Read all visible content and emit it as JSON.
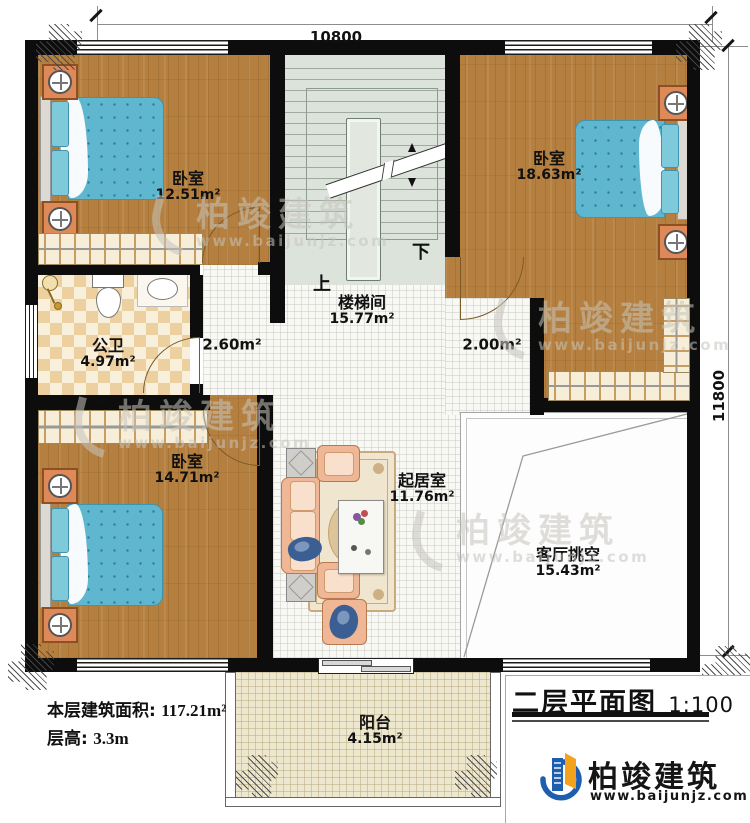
{
  "drawing": {
    "title": "二层平面图",
    "scale": "1:100",
    "dim_top": "10800",
    "dim_right": "11800"
  },
  "rooms": {
    "bedroom_tl": {
      "name": "卧室",
      "area": "12.51m²"
    },
    "bedroom_tr": {
      "name": "卧室",
      "area": "18.63m²"
    },
    "bedroom_bl": {
      "name": "卧室",
      "area": "14.71m²"
    },
    "bathroom": {
      "name": "公卫",
      "area": "4.97m²"
    },
    "stairwell": {
      "name": "楼梯间",
      "area": "15.77m²"
    },
    "hall_left": {
      "area": "2.60m²"
    },
    "hall_right": {
      "area": "2.00m²"
    },
    "living": {
      "name": "起居室",
      "area": "11.76m²"
    },
    "void": {
      "name": "客厅挑空",
      "area": "15.43m²"
    },
    "balcony": {
      "name": "阳台",
      "area": "4.15m²"
    }
  },
  "stairs": {
    "up": "上",
    "down": "下"
  },
  "info": {
    "area_label": "本层建筑面积:",
    "area_value": "117.21m²",
    "height_label": "层高:",
    "height_value": "3.3m"
  },
  "brand": {
    "name": "柏竣建筑",
    "website": "www.baijunjz.com"
  },
  "colors": {
    "wall": "#0d0d0d",
    "wood_floor": "#b5803f",
    "stair_floor": "#dce3da",
    "bed_blue": "#5fb6cf",
    "logo_blue": "#1d5fae",
    "logo_orange": "#f2a21c"
  }
}
